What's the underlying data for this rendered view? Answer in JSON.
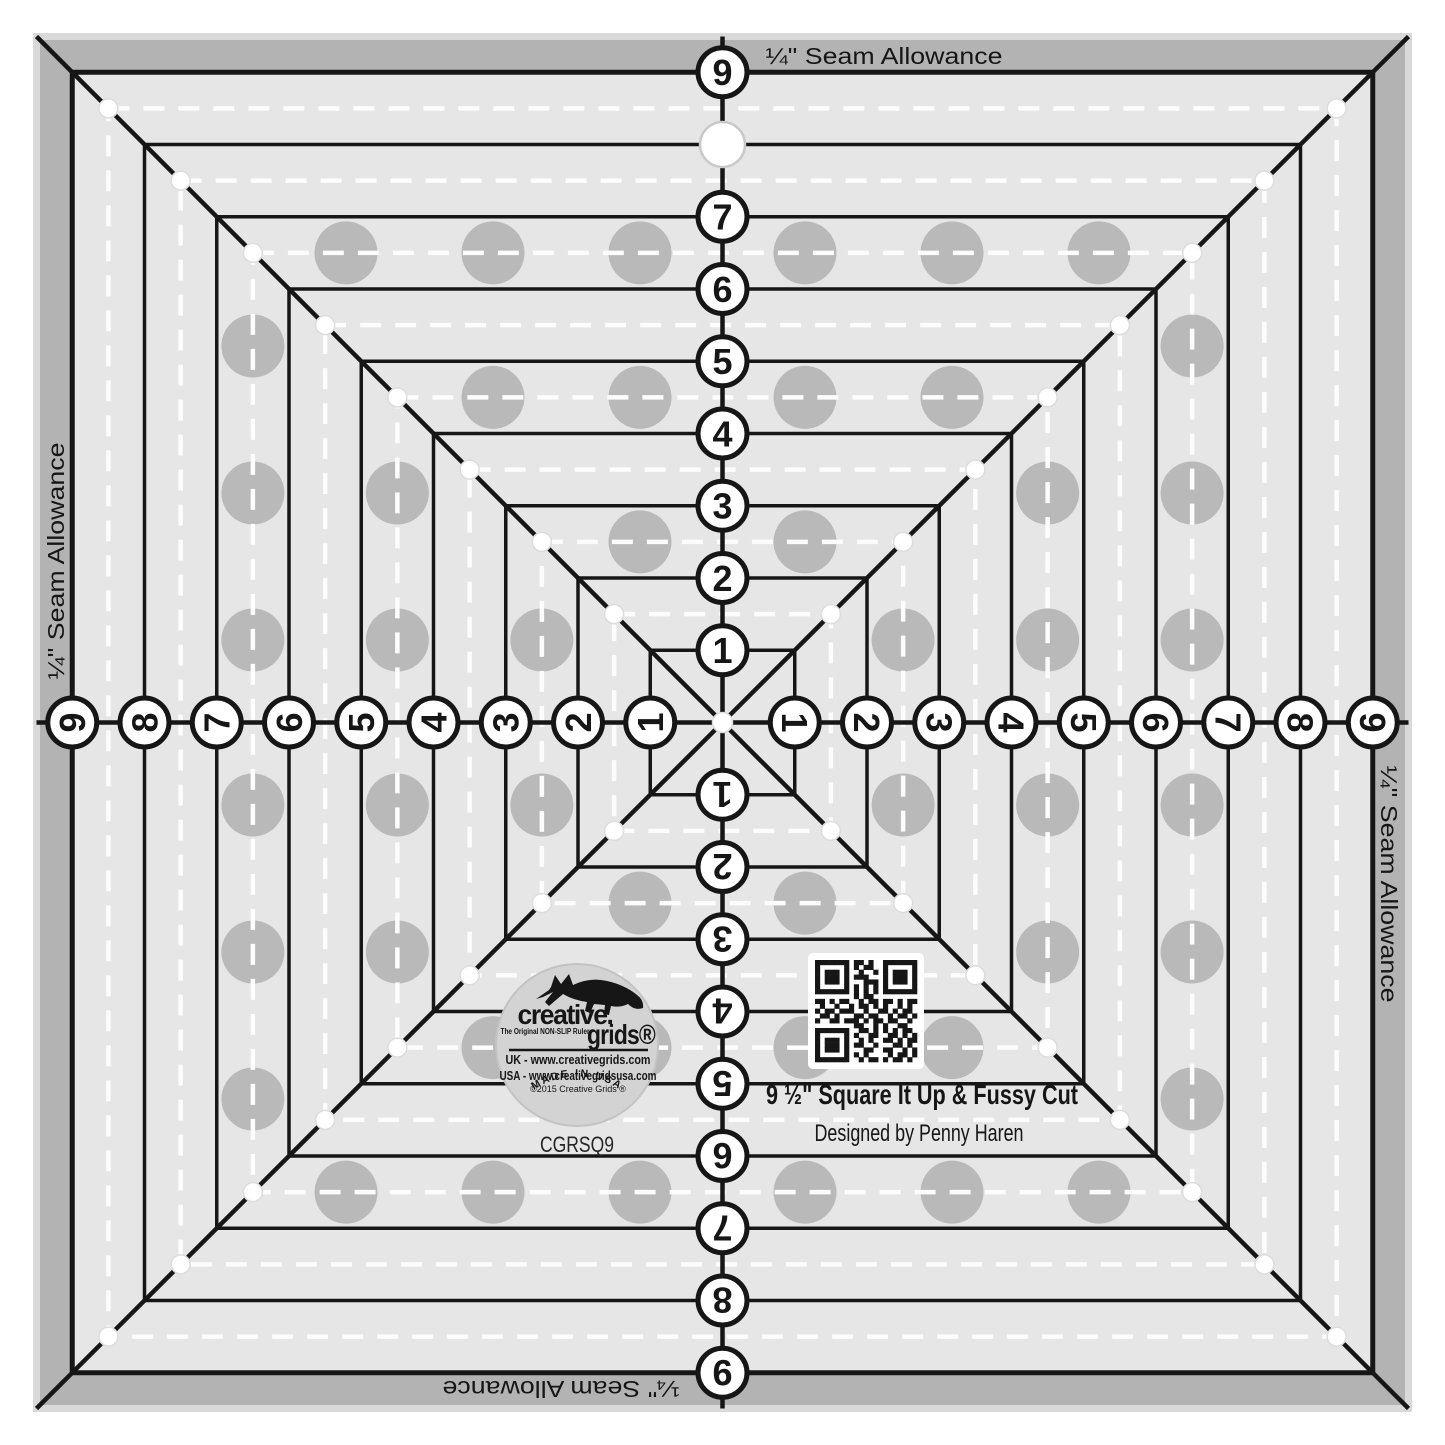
{
  "product": {
    "title": "9 ½\" Square It Up & Fussy Cut",
    "designer": "Designed by Penny Haren",
    "sku": "CGRSQ9"
  },
  "seam_labels": [
    {
      "text": "¼\" Seam Allowance",
      "x": 884,
      "y": 56,
      "rotation": 0,
      "length": 237
    },
    {
      "text": "¼\" Seam Allowance",
      "x": 1389,
      "y": 884,
      "rotation": 90,
      "length": 237
    },
    {
      "text": "¼\" Seam Allowance",
      "x": 561,
      "y": 1389,
      "rotation": 180,
      "length": 237
    },
    {
      "text": "¼\" Seam Allowance",
      "x": 56,
      "y": 561,
      "rotation": -90,
      "length": 237
    }
  ],
  "scales": {
    "top": {
      "rotation": 0,
      "values": [
        1,
        2,
        3,
        4,
        5,
        6,
        7,
        9
      ]
    },
    "right": {
      "rotation": 90,
      "values": [
        1,
        2,
        3,
        4,
        5,
        6,
        7,
        8,
        9
      ]
    },
    "bottom": {
      "rotation": 180,
      "values": [
        1,
        2,
        3,
        4,
        5,
        6,
        7,
        8,
        9
      ]
    },
    "left": {
      "rotation": -90,
      "values": [
        1,
        2,
        3,
        4,
        5,
        6,
        7,
        8,
        9
      ]
    }
  },
  "logo": {
    "brand_top": "creative.",
    "brand_bottom": "grids®",
    "tagline": "The Original NON-SLIP Ruler",
    "url_uk": "UK - www.creativegrids.com",
    "url_usa": "USA - www.creativegridsusa.com",
    "copyright": "©2015 Creative Grids ®",
    "made_in": "MADE IN USA"
  },
  "geometry": {
    "canvas": 1445,
    "center": 722.5,
    "half_inch_px": 72.25,
    "edge_half_px": 686,
    "square_inches": [
      1,
      2,
      3,
      4,
      5,
      6,
      7,
      8,
      9
    ],
    "dashed_mid_inches": [
      1.5,
      2.5,
      3.5,
      4.5,
      5.5,
      6.5,
      7.5,
      8.5
    ],
    "grip_mid_inches": [
      2.5,
      4.5,
      6.5
    ],
    "grip_offsets_px": [
      82.5,
      229.5,
      376.5
    ],
    "grip_radius_px": 31.5,
    "hole_inch": 8,
    "badge": {
      "cx": 577,
      "cy": 1045,
      "r": 81
    },
    "qr": {
      "x": 808,
      "y": 953,
      "size": 116,
      "modules": 21,
      "pad": 7
    }
  },
  "colors": {
    "canvas": "#ffffff",
    "edge_strip": "#d9d9d9",
    "seam_band": "#b3b3b3",
    "surface": "#e6e6e6",
    "ink": "#161616",
    "dash": "#fcfcfc",
    "grip_dot": "#b9b9b9",
    "corner_dot_ring": "#dddddd",
    "hole_ring": "#c9c9c9",
    "badge_fill": "#d3d3d3",
    "badge_edge": "#c3c3c3",
    "white": "#ffffff",
    "sku_ink": "#262626"
  },
  "qr_matrix": [
    "111111101101001111111",
    "100000101011001000001",
    "101110100100101011101",
    "101110101110001011101",
    "101110100011101011101",
    "100000101010101000001",
    "111111101010101111111",
    "000000001011000000000",
    "110101100101101101011",
    "010010010110101001010",
    "101101110010011010110",
    "011010001101100101101",
    "100110111010110110010",
    "000000001100101001100",
    "111111100110101010110",
    "100000101001100110101",
    "101110100101001101011",
    "101110101100100011010",
    "101110100011001100101",
    "100000101010000101101",
    "111111100101101011010"
  ]
}
